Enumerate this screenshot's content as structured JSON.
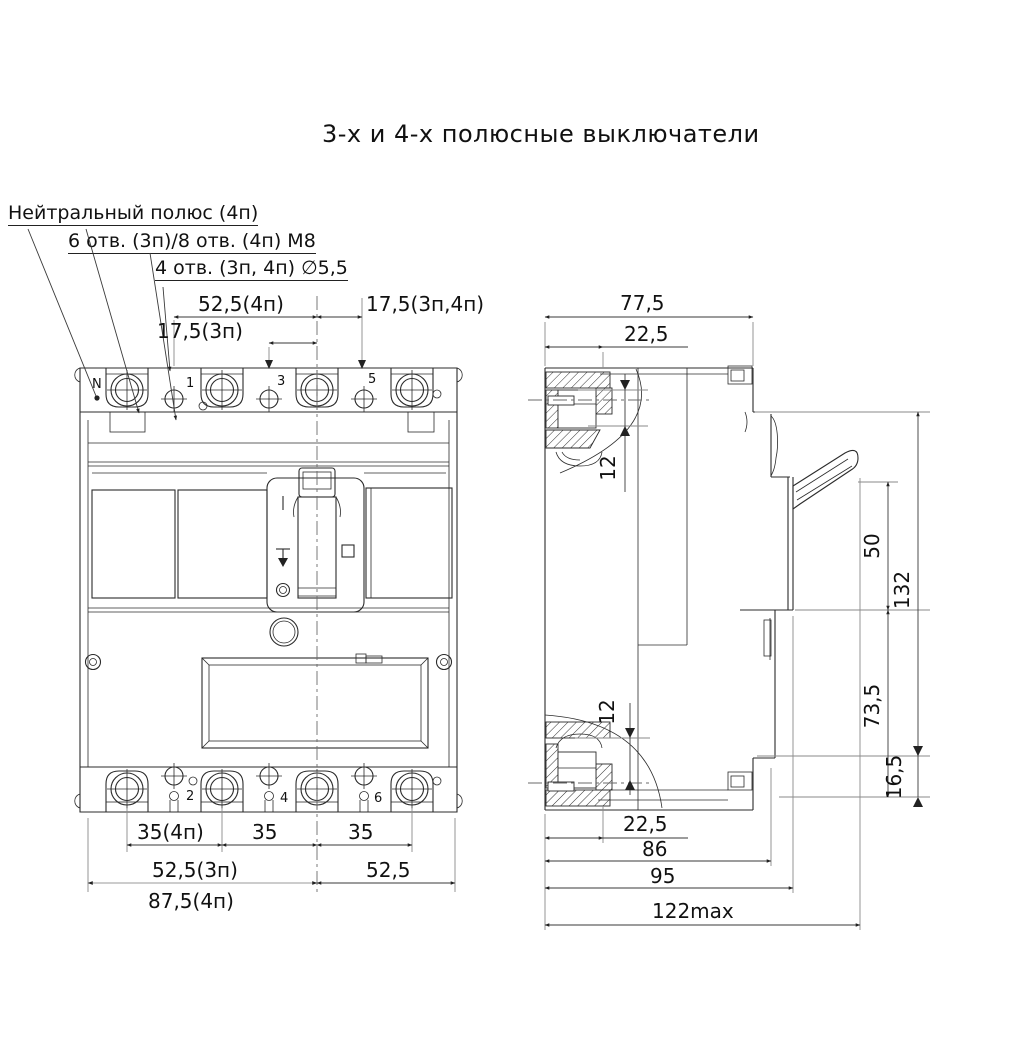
{
  "title": "3-х и 4-х полюсные выключатели",
  "callouts": {
    "neutral_pole": "Нейтральный полюс (4п)",
    "holes_m8": "6 отв. (3п)/8 отв. (4п) М8",
    "holes_55": "4 отв. (3п, 4п) ∅5,5"
  },
  "front": {
    "labels": {
      "n": "N",
      "p1": "1",
      "p3": "3",
      "p5": "5",
      "p2": "2",
      "p4": "4",
      "p6": "6"
    },
    "dims": {
      "d52_4p": "52,5(4п)",
      "d17_3p": "17,5(3п)",
      "d17_34p": "17,5(3п,4п)",
      "d35_4p": "35(4п)",
      "d35a": "35",
      "d35b": "35",
      "d52_3p": "52,5(3п)",
      "d52": "52,5",
      "d87_4p": "87,5(4п)"
    }
  },
  "side": {
    "dims": {
      "w77": "77,5",
      "t22": "22,5",
      "t12": "12",
      "h50": "50",
      "h132": "132",
      "h73": "73,5",
      "h16": "16,5",
      "b12": "12",
      "b22": "22,5",
      "d86": "86",
      "d95": "95",
      "d122": "122max"
    }
  }
}
